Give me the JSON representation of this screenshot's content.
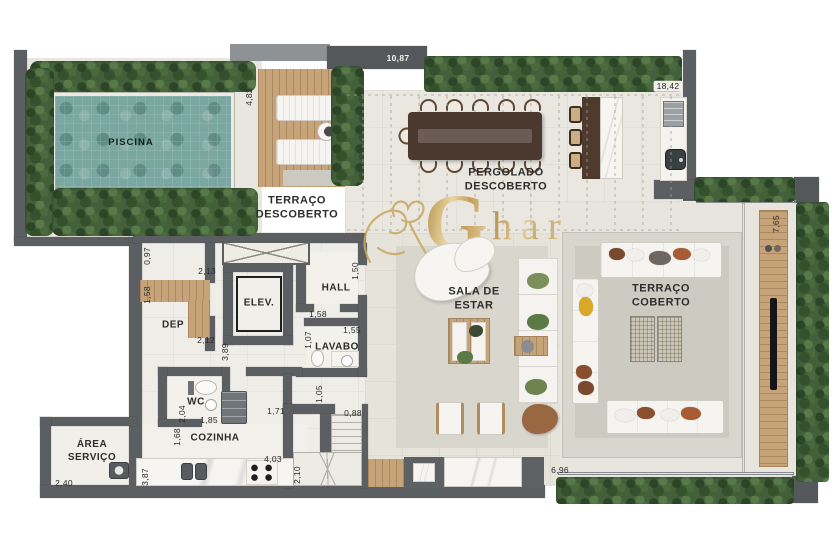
{
  "watermark": {
    "initial": "G",
    "rest": "har"
  },
  "rooms": {
    "piscina": "PISCINA",
    "terraco_descoberto": "TERRAÇO\nDESCOBERTO",
    "pergolado": "PERGOLADO\nDESCOBERTO",
    "sala": "SALA DE\nESTAR",
    "terraco_coberto": "TERRAÇO\nCOBERTO",
    "elev": "ELEV.",
    "hall": "HALL",
    "dep": "DEP",
    "lavabo": "LAVABO",
    "wc": "WC",
    "cozinha": "COZINHA",
    "area_servico": "ÁREA\nSERVIÇO"
  },
  "dimensions": {
    "pool_side": "4,82",
    "deck_top": "10,87",
    "gourmet_top": "18,42",
    "terrace_panel": "7,65",
    "dep_entry": "0,97",
    "dep_width": "2,13",
    "dep_door": "1,58",
    "dep_bottom": "2,12",
    "hall_door": "1,50",
    "hall_bottom": "1,58",
    "lavabo_width": "1,55",
    "lavabo_door": "1,07",
    "corridor": "3,89",
    "wc_height": "2,04",
    "wc_width": "1,85",
    "wc_lower": "1,68",
    "kitchen_pass": "1,71",
    "stairs_pass": "1,05",
    "stairs_width": "0,88",
    "kitchen_width": "4,03",
    "kitchen_side": "2,10",
    "kitchen_height": "3,87",
    "servico_width": "2,40",
    "living_width": "6,96"
  },
  "colors": {
    "wall": "#5b5f62",
    "pool": "#7aa7a2",
    "hedge": "#42603a",
    "wood": "#c6a378",
    "floor": "#ece9e2",
    "gold": "#c9a85f",
    "platform": "#d9d6ce"
  }
}
